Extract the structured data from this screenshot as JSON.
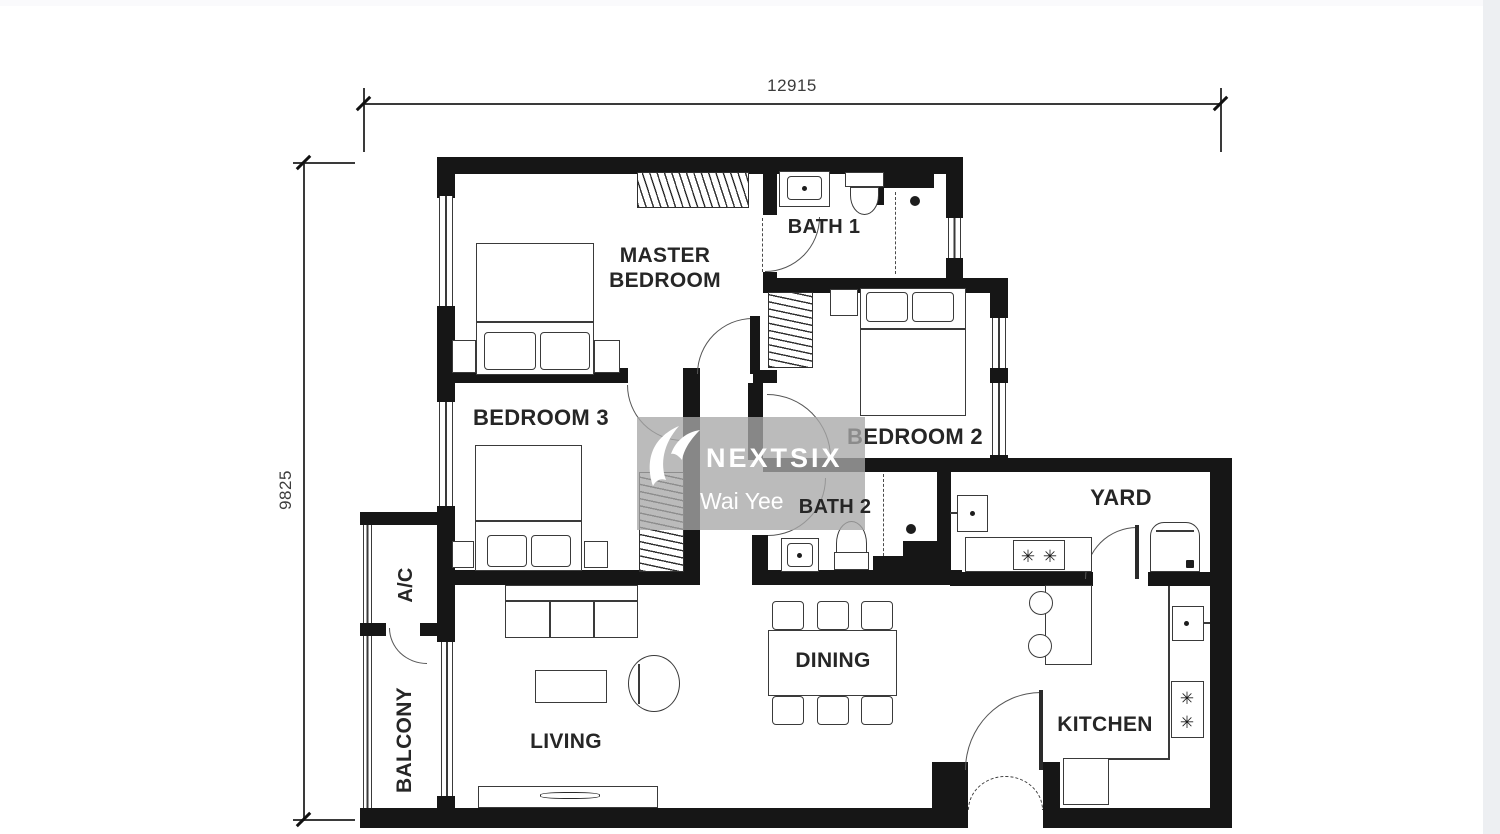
{
  "dimensions": {
    "top": "12915",
    "left": "9825"
  },
  "watermark": {
    "brand": "NEXTSIX",
    "name": "Wai Yee"
  },
  "rooms": {
    "master_bedroom": "MASTER BEDROOM",
    "bath1": "BATH 1",
    "bedroom2": "BEDROOM 2",
    "bedroom3": "BEDROOM 3",
    "bath2": "BATH 2",
    "yard": "YARD",
    "dining": "DINING",
    "kitchen": "KITCHEN",
    "living": "LIVING",
    "balcony": "BALCONY",
    "ac": "A/C"
  },
  "icons": {
    "burner": "✳"
  },
  "colors": {
    "wall": "#161616",
    "line": "#3a3a3a",
    "label": "#262626",
    "watermark_bg": "rgba(168,168,168,0.78)",
    "watermark_text": "#ffffff",
    "edge_strip": "#edeff2"
  }
}
